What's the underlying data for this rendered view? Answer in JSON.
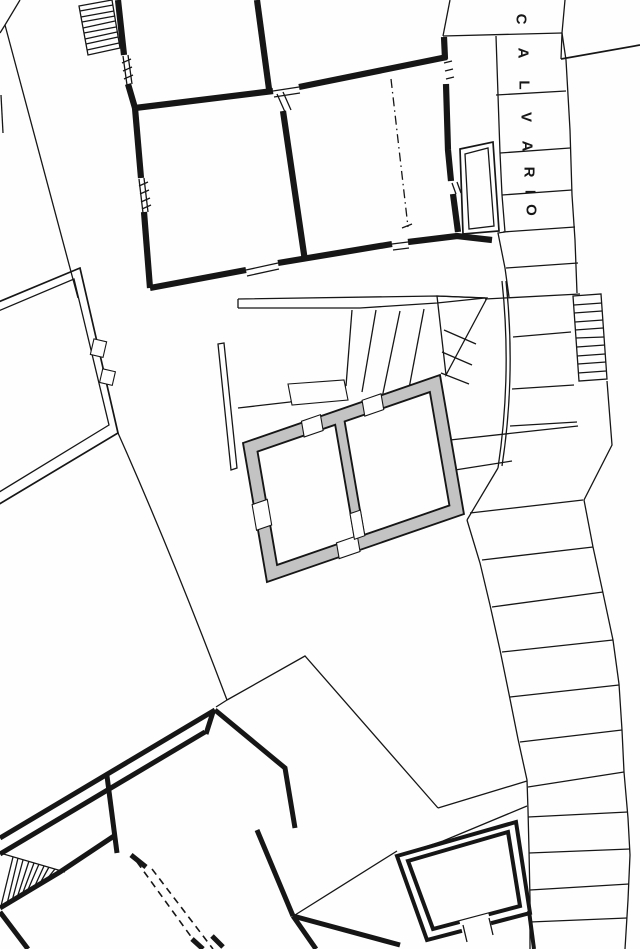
{
  "figure": {
    "kind": "scanned architectural site plan",
    "street": {
      "label": "CALVARIO"
    },
    "colors": {
      "paper": "#fefefe",
      "ink": "#161616",
      "highlight": "#c3c3c3"
    }
  }
}
